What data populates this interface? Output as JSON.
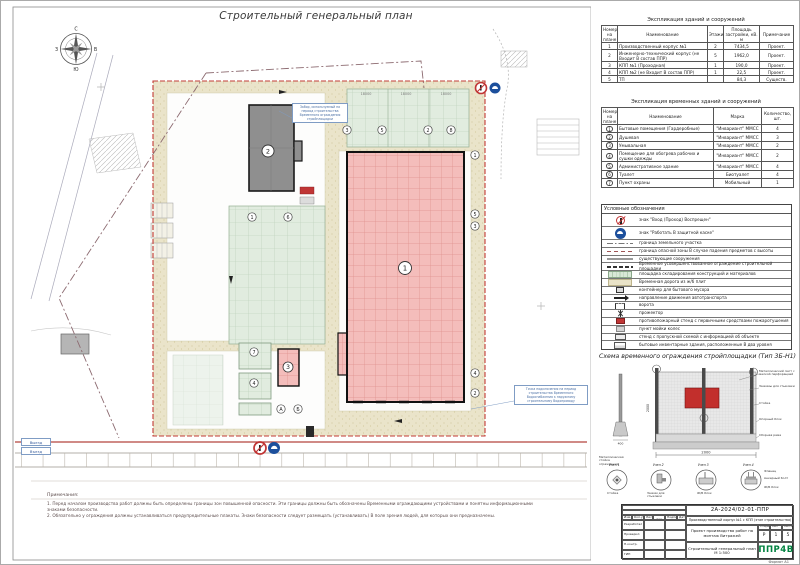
{
  "sheet": {
    "title": "Строительный генеральный план",
    "format_note": "Формат А1"
  },
  "compass": {
    "n": "С",
    "e": "В",
    "s": "Ю",
    "w": "З"
  },
  "plan": {
    "scale_dims": [
      "18000",
      "18000",
      "18000"
    ],
    "markers": [
      "3",
      "5",
      "2",
      "8",
      "1",
      "6",
      "1",
      "5",
      "3",
      "4",
      "2",
      "7",
      "4",
      "А",
      "Б"
    ],
    "building_labels": {
      "b1": "1",
      "b2": "2",
      "b3": "3"
    },
    "callout_fence": "Забор, используемый на период строительства Временного ограждения стройплощадки",
    "callout_water": "Точка подключения на период строительства Временного Водоснабжения к наружному строительному Водопроводу",
    "gate_out": "Выезд",
    "gate_in": "Въезд"
  },
  "notes": {
    "title": "Примечания:",
    "item1": "1. Перед началом производства работ должны быть определены границы зон повышенной опасности. Эти границы должны быть обозначены Временными ограждающими устройствами и понятны информационными знаками безопасности.",
    "item2": "2. Обязательно у ограждения должны устанавливаться предупредительные плакаты. Знаки безопасности следует размещать (устанавливать) В поле зрения людей, для которых они предназначены."
  },
  "buildings_table": {
    "title": "Экспликация зданий и сооружений",
    "headers": {
      "num": "Номер на плане",
      "name": "Наименование",
      "floors": "Этажи",
      "area": "Площадь застройки, кВ. м",
      "note": "Примечание"
    },
    "rows": [
      {
        "num": "1",
        "name": "Производственный корпус №1",
        "floors": "2",
        "area": "7434,5",
        "note": "Проект."
      },
      {
        "num": "2",
        "name": "Инженерно-технический корпус (не Входит В состав ППР)",
        "floors": "5",
        "area": "1962,0",
        "note": "Проект."
      },
      {
        "num": "3",
        "name": "КПП №1 (Проходная)",
        "floors": "1",
        "area": "190,0",
        "note": "Проект."
      },
      {
        "num": "4",
        "name": "КПП №2 (не Входит В состав ППР)",
        "floors": "1",
        "area": "22,5",
        "note": "Проект."
      },
      {
        "num": "5",
        "name": "ТП",
        "floors": "",
        "area": "84,3",
        "note": "Существ."
      }
    ]
  },
  "temp_table": {
    "title": "Экспликация временных зданий и сооружений",
    "headers": {
      "num": "Номер на плане",
      "name": "Наименование",
      "mark": "Марка",
      "qty": "Количество, шт."
    },
    "rows": [
      {
        "num": "1",
        "name": "Бытовые помещения (Гардеробные)",
        "mark": "\"Инвариант\" ММСС",
        "qty": "4"
      },
      {
        "num": "2",
        "name": "Душевая",
        "mark": "\"Инвариант\" ММСС",
        "qty": "3"
      },
      {
        "num": "3",
        "name": "Умывальная",
        "mark": "\"Инвариант\" ММСС",
        "qty": "2"
      },
      {
        "num": "4",
        "name": "Помещение для обогрева рабочих и сушки одежды",
        "mark": "\"Инвариант\" ММСС",
        "qty": "2"
      },
      {
        "num": "5",
        "name": "Административное здание",
        "mark": "\"Инвариант\" ММСС",
        "qty": "4"
      },
      {
        "num": "6",
        "name": "Туалет",
        "mark": "Биотуалет",
        "qty": "4"
      },
      {
        "num": "7",
        "name": "Пункт охраны",
        "mark": "Мобильный",
        "qty": "1"
      }
    ]
  },
  "legend": {
    "title": "Условные обозначения",
    "items": [
      {
        "icon": "no-pedestrian-sign",
        "text": "знак \"Вход (Проход) Воспрещен\""
      },
      {
        "icon": "helmet-sign",
        "text": "знак \"Работать В защитной каске\""
      },
      {
        "icon": "parcel-boundary-line",
        "text": "граница земельного участка"
      },
      {
        "icon": "danger-zone-line",
        "text": "граница опасной зоны В случае падения предметов с высоты"
      },
      {
        "icon": "existing-structures-line",
        "text": "существующие сооружения"
      },
      {
        "icon": "temp-fence-line",
        "text": "Временное усовершенствованное ограждение строительной площадки"
      },
      {
        "icon": "storage-area-swatch",
        "text": "площадка складирования конструкций и материалов"
      },
      {
        "icon": "temp-road-swatch",
        "text": "Временная дорога из ж/б плит"
      },
      {
        "icon": "waste-container",
        "text": "контейнер для бытового мусора"
      },
      {
        "icon": "traffic-arrow",
        "text": "направление движения автотранспорта"
      },
      {
        "icon": "gate",
        "text": "ворота"
      },
      {
        "icon": "floodlight",
        "text": "прожектор"
      },
      {
        "icon": "fire-stand",
        "text": "противопожарный стенд с первичными средствами пожаротушения"
      },
      {
        "icon": "wheel-wash",
        "text": "пункт мойки колес"
      },
      {
        "icon": "info-stand",
        "text": "стенд с пропускной схемой с информацией об объекте"
      },
      {
        "icon": "two-level-cabins",
        "text": "бытовые инвентарные здания, расположенные В два уровня"
      }
    ]
  },
  "fence": {
    "title": "Схема временного ограждения стройплощадки (Тип 3Б-Н1)",
    "labels": {
      "sheet": "Металлический лист с мелкой перфорацией",
      "clamps": "Зажимы для стыковки",
      "post": "Стойка",
      "block": "Опорный блок",
      "frame": "Сборная рама",
      "post_standalone": "Металлическая стойка ограждения",
      "node1": "Узел 1",
      "node2": "Узел 2",
      "node3": "Узел 3",
      "node4": "Узел 4",
      "node1_sub": "Стойка",
      "node2_sub": "Зажим для стыковки",
      "node3_sub": "Ж/Б блок",
      "node4_sub1": "Фланец",
      "node4_sub2": "Анкерный болт",
      "node4_sub3": "Ж/Б блок"
    },
    "dims": {
      "width": "2000",
      "base": "400",
      "height": "2000"
    }
  },
  "titleblock": {
    "doc_number": "2А-2024/02-01-ППР",
    "object": "Производственный корпус №1 с КПП (этап строительства)",
    "subject": "Проект производства работ на монтаж Витражей",
    "drawing_name": "Строительный генеральный план М 1:500",
    "stage_label": "Стадия",
    "sheet_label": "Лист",
    "sheets_label": "Листов",
    "stage": "Р",
    "sheet": "1",
    "sheets": "5",
    "logo": "ППР4В",
    "sig_headers": [
      "Изм.",
      "Кол.уч.",
      "Лист",
      "№ док.",
      "Подпись",
      "Дата"
    ],
    "sig_rows": [
      "Разработал",
      "Проверил",
      "Н.контр.",
      "ГИП"
    ]
  }
}
